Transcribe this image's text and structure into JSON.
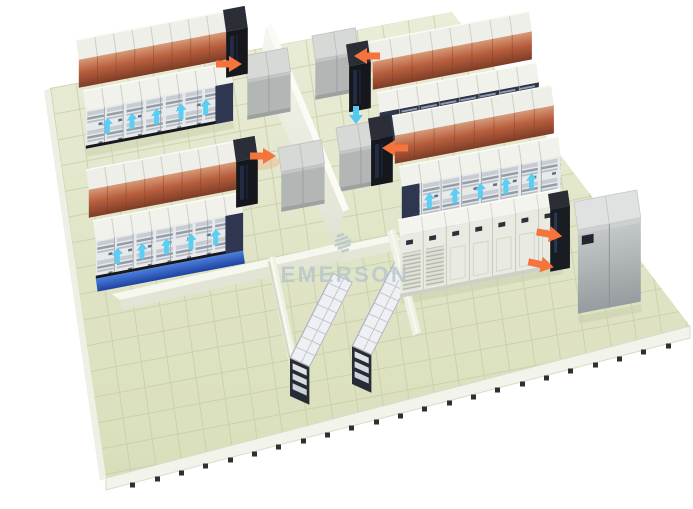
{
  "meta": {
    "description": "3D rendered data center room layout with hot and cold airflow arrows",
    "background": "#ffffff"
  },
  "watermark": {
    "text": "EMERSON",
    "logo": "emerson-diamond-logo",
    "color": "#b7c4cc"
  },
  "palette": {
    "floor": "#e0e4c6",
    "floor_grid": "#c7cda8",
    "wall": "#eef0e3",
    "rack_top": "#eff1ea",
    "server_front": "#e7e9ea",
    "perforated_front": "#2c3446",
    "hot_aisle": "#b85f3e",
    "black_end_rack": "#15171c",
    "cooling_unit": "#b2b6b5",
    "hot_arrow": "#f4743c",
    "cold_arrow": "#5ccdf3",
    "plenum_blue": "#2a58c8",
    "battery_frame": "#1e222a",
    "battery_module": "#e8ebef",
    "power_cabinet": "#e9ebe2",
    "enclosure": "#aeb4b6",
    "pedestal": "#2e3032"
  },
  "inventory": {
    "left_rack_rows": 4,
    "right_rack_rows": 4,
    "racks_per_row": 8,
    "hot_aisles": 4,
    "row_cooling_unit_groups": 4,
    "battery_racks": 2,
    "power_cabinets": 7,
    "heat_rejection_units": 1,
    "hot_airflow_arrows": 6,
    "cold_airflow_arrows": 21,
    "cold_plenum_strips": 2
  }
}
